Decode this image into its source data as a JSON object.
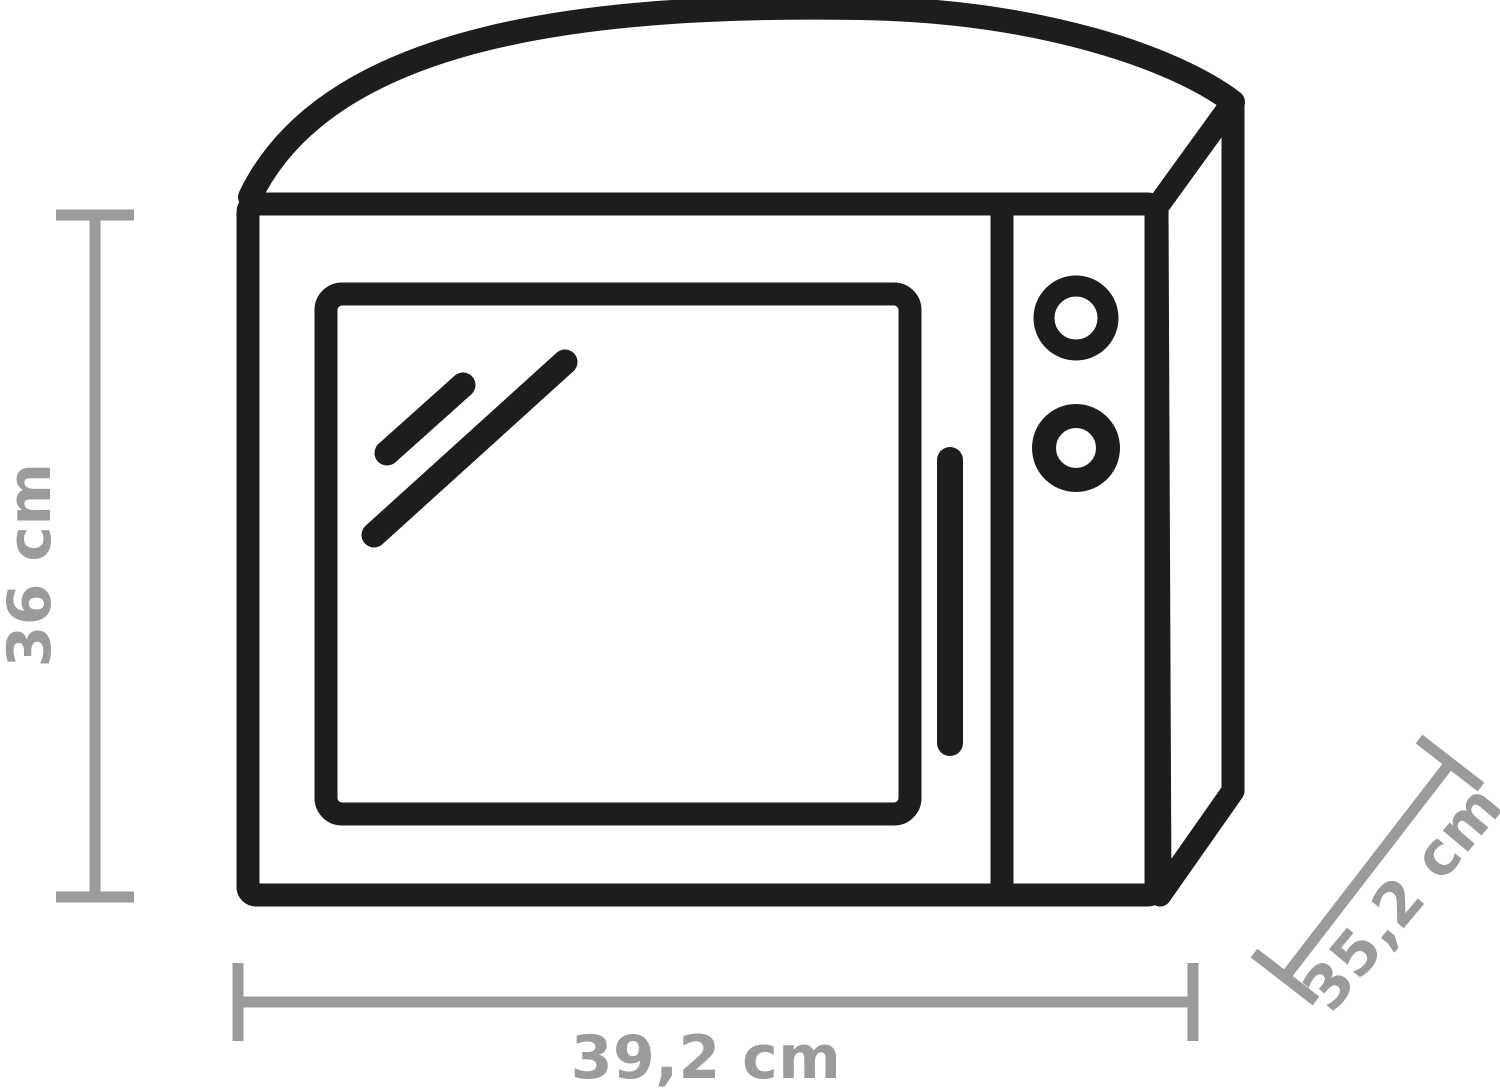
{
  "figure": {
    "subject": "microwave-outline-icon",
    "background": "#ffffff"
  },
  "colors": {
    "ink": "#1d1d1b",
    "dimension": "#9b9b9b",
    "background": "#ffffff"
  },
  "dimensions": {
    "height": {
      "label": "36 cm",
      "value": 36,
      "unit": "cm",
      "orientation": "vertical-left"
    },
    "width": {
      "label": "39,2 cm",
      "value": 39.2,
      "unit": "cm",
      "orientation": "horizontal-bottom"
    },
    "depth": {
      "label": "35,2 cm",
      "value": 35.2,
      "unit": "cm",
      "orientation": "diagonal-right"
    }
  }
}
